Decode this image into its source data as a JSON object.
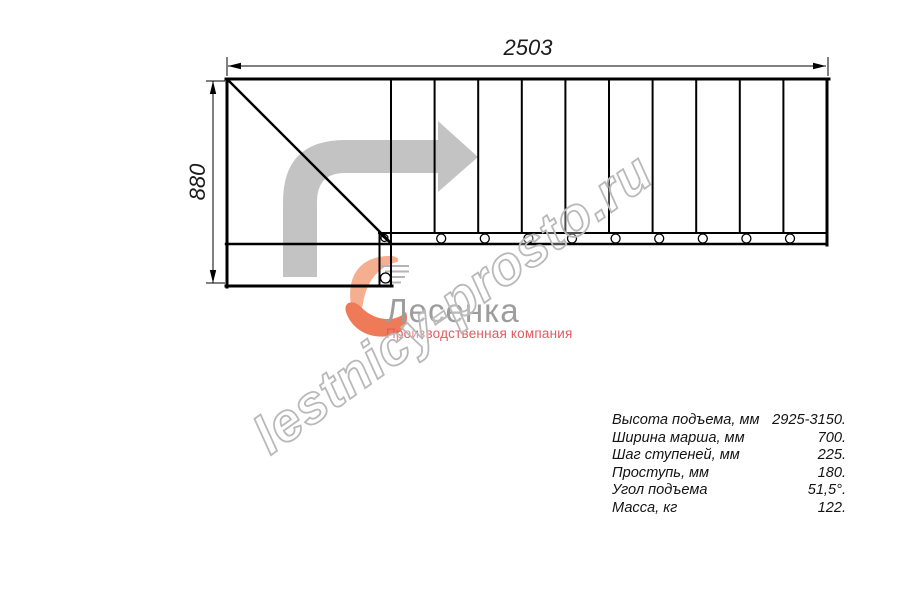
{
  "watermark": "lestnicy-prosto.ru",
  "dimensions": {
    "width_label": "2503",
    "height_label": "880"
  },
  "logo": {
    "name": "Лесенка",
    "tagline": "Производственная компания"
  },
  "specs": {
    "rows": [
      {
        "label": "Высота подъема, мм",
        "value": "2925-3150."
      },
      {
        "label": "Ширина марша, мм",
        "value": "700."
      },
      {
        "label": "Шаг ступеней, мм",
        "value": "225."
      },
      {
        "label": "Проступь, мм",
        "value": "180."
      },
      {
        "label": "Угол подъема",
        "value": "51,5°."
      },
      {
        "label": "Масса, кг",
        "value": "122."
      }
    ]
  },
  "plan": {
    "tread_count": 10,
    "baluster_count": 9,
    "tread_start_x": 391,
    "tread_step_x": 43.6,
    "baluster_offset_x": 6.6
  },
  "colors": {
    "line": "#000000",
    "direction_arrow": "#c3c3c3",
    "watermark_outline": "#b9b9b9",
    "logo_text": "#9d9d9d",
    "logo_red": "#e05a61",
    "swoosh_light": "#f5ae90",
    "swoosh_dark": "#ee7a58"
  }
}
